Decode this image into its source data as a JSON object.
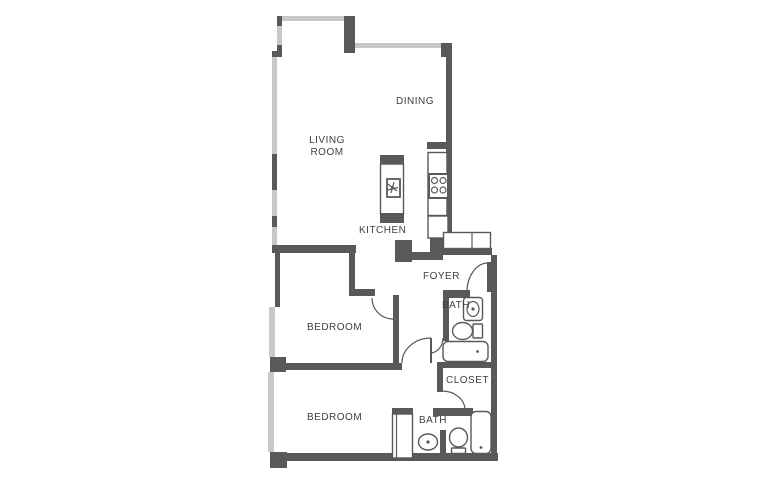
{
  "title": "Two bedroom apartment floor plan",
  "colors": {
    "wall_dark": "#58595b",
    "wall_light": "#c7c8ca",
    "line": "#58595b",
    "text": "#3f3f41",
    "bg": "#ffffff"
  },
  "rooms": {
    "living_room": {
      "line1": "LIVING",
      "line2": "ROOM"
    },
    "dining": {
      "label": "DINING"
    },
    "kitchen": {
      "label": "KITCHEN"
    },
    "foyer": {
      "label": "FOYER"
    },
    "bath_upper": {
      "label": "BATH"
    },
    "closet": {
      "label": "CLOSET"
    },
    "bedroom_upper": {
      "label": "BEDROOM"
    },
    "bedroom_lower": {
      "label": "BEDROOM"
    },
    "bath_lower": {
      "label": "BATH"
    }
  },
  "fixtures": [
    "kitchen-island",
    "island-sink",
    "range-burners",
    "kitchen-counter",
    "dishwasher",
    "foyer-coat-closet",
    "vanity-sink",
    "toilet",
    "bathtub",
    "bedroom-wardrobe",
    "oval-sink",
    "toilet",
    "bathtub"
  ]
}
